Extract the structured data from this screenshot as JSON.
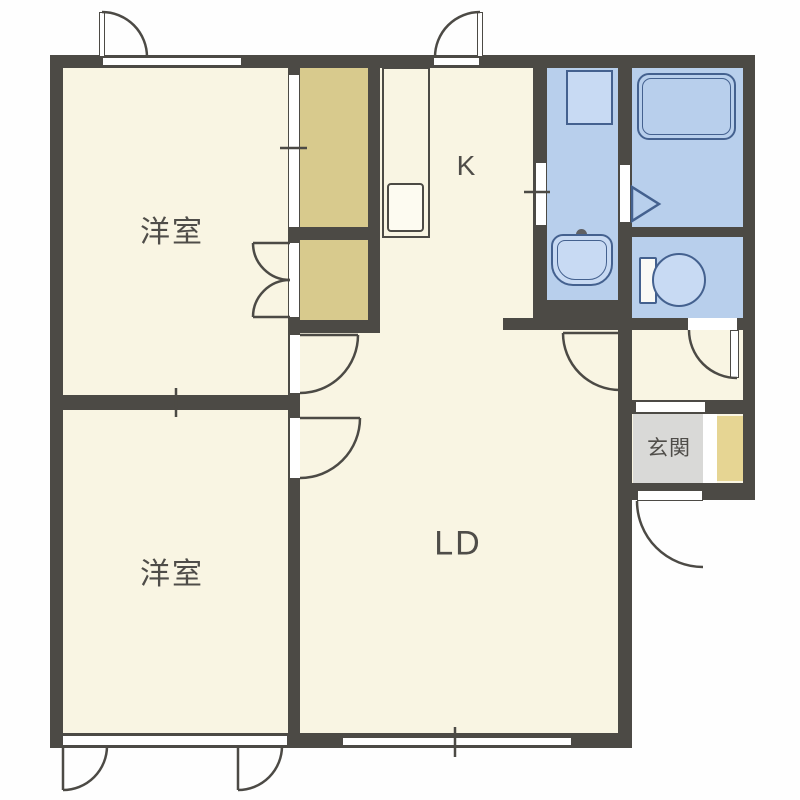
{
  "title": "2LDK apartment floor plan",
  "colors": {
    "wall": "#4c4a45",
    "floor": "#f9f5e3",
    "closet": "#d8ca8d",
    "shoe": "#e6d593",
    "wet": "#b8cfec",
    "wetfill": "#c8daf3",
    "wetline": "#44618f",
    "genkan": "#d9d9d7",
    "ink": "#4f4d49"
  },
  "rooms": {
    "bedroom_top": {
      "label": "洋室"
    },
    "bedroom_bottom": {
      "label": "洋室"
    },
    "kitchen": {
      "label": "K"
    },
    "living_dining": {
      "label": "LD"
    },
    "entrance": {
      "label": "玄関"
    }
  }
}
